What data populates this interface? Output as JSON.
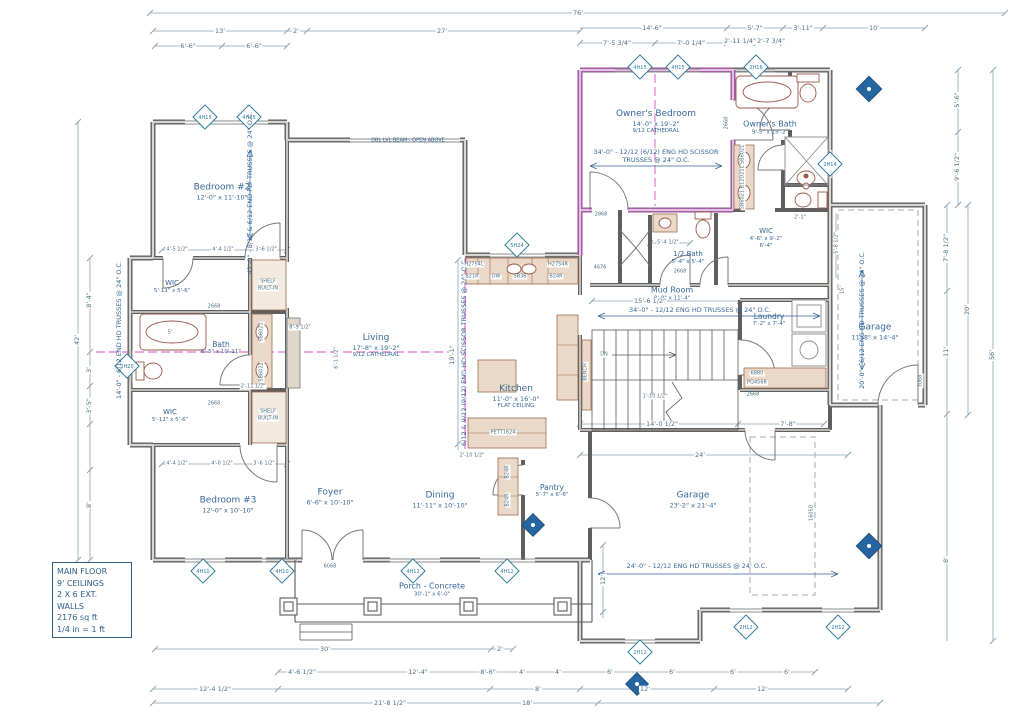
{
  "drawing": {
    "title_block": {
      "lines": [
        "MAIN FLOOR",
        "9' CEILINGS",
        "2 X 6 EXT.",
        "WALLS",
        "2176 sq ft",
        "1/4 in = 1 ft"
      ]
    },
    "rooms": {
      "bedroom2": {
        "name": "Bedroom #2",
        "size": "12'-0\" x 11'-10\""
      },
      "wic_top": {
        "name": "WIC",
        "size": "5'-11\" x 5'-6\""
      },
      "bath": {
        "name": "Bath",
        "size": "6'-5\" x 10'-11\""
      },
      "wic_bottom": {
        "name": "WIC",
        "size": "5'-11\" x 5'-6\""
      },
      "bedroom3": {
        "name": "Bedroom #3",
        "size": "12'-0\" x 10'-10\""
      },
      "foyer": {
        "name": "Foyer",
        "size": "6'-6\" x 10'-10\""
      },
      "living": {
        "name": "Living",
        "size": "17'-8\" x 19'-2\"",
        "note": "9/12 CATHEDRAL"
      },
      "dining": {
        "name": "Dining",
        "size": "11'-11\" x 10'-10\""
      },
      "kitchen": {
        "name": "Kitchen",
        "size": "11'-0\" x 16'-0\"",
        "note": "FLAT CEILING"
      },
      "pantry": {
        "name": "Pantry",
        "size": "5'-7\" x 6'-6\""
      },
      "owners_bedroom": {
        "name": "Owner's Bedroom",
        "size": "14'-0\" x 19'-2\"",
        "note": "9/12 CATHEDRAL"
      },
      "owners_bath": {
        "name": "Owner's Bath",
        "size": "9'-5\" x 19'-2\""
      },
      "owners_wic": {
        "name": "WIC",
        "size": "4'-6\" x 9'-2\"",
        "note": "6'-4\""
      },
      "half_bath": {
        "name": "1/2 Bath",
        "size": "5'-4\" x 5'-4\""
      },
      "mud_room": {
        "name": "Mud Room",
        "size": "8'-8\" x 11'-4\""
      },
      "laundry": {
        "name": "Laundry",
        "size": "7'-2\" x 7'-4\""
      },
      "garage_single": {
        "name": "Garage",
        "size": "11'-8\" x 14'-4\""
      },
      "garage_main": {
        "name": "Garage",
        "size": "23'-2\" x 21'-4\""
      },
      "porch": {
        "name": "Porch - Concrete",
        "size": "30'-1\" x 6'-0\""
      }
    },
    "truss_notes": {
      "left_wing": "42'-0\" - 8/12 & 6/12 END PLY TRUSSES @ 24\" O.C.",
      "owners_line1": "34'-0\" - 12/12 (6/12) ENG HD SCISSOR",
      "owners_line2": "TRUSSES @ 24\" O.C.",
      "living": "6/12 & 9/12 (9/12) ENG HD SCISSOR TRUSSES @ 24\" O.C.",
      "mud": "34'-0\" - 12/12 ENG HD TRUSSES @ 24\" O.C.",
      "garage_single": "20'-0\" - 6/12 ENG HD TRUSSES @ 24\" O.C.",
      "garage_main": "24'-0\" - 12/12 ENG HD TRUSSES @ 24' O.C.",
      "left_bump": "14'-0\" - 6/12 END HD TRUSSES @ 24\" O.C.",
      "beam": "DBL LVL BEAM - OPEN ABOVE"
    },
    "dims": {
      "top": [
        "76'",
        "13'",
        "2'",
        "27'",
        "14'-6\"",
        "5'-7\"",
        "3'-11\"",
        "10'"
      ],
      "top2": [
        "6'-6\"",
        "6'-6\"",
        "7'-5 3/4\"",
        "7'-0 1/4\"",
        "2'-11 1/4\"",
        "2'-7 3/4\""
      ],
      "right": [
        "5'-6\"",
        "9'-6 1/2\"",
        "7'-8 1/2\"",
        "11'",
        "20'",
        "8'",
        "56'",
        "5'-8 1/2\"",
        "15'"
      ],
      "left": [
        "42'",
        "8'-4\"",
        "3'",
        "3'-5\"",
        "8'"
      ],
      "bottom": [
        "30'",
        "2'",
        "4'-6 1/2\"",
        "12'-4\"",
        "8'-6\"",
        "4'",
        "4'",
        "6'",
        "6'",
        "6'",
        "6'",
        "12'-4 1/2\"",
        "8'",
        "12'",
        "12'",
        "21'-8 1/2\"",
        "18'"
      ],
      "interior": [
        "4'-5 1/2\"",
        "4'-4 1/2\"",
        "3'-6 1/2\"",
        "4'-4 1/2\"",
        "4'-0 1/2\"",
        "3'-6 1/2\"",
        "15'-6 1/2\"",
        "14'-0 1/2\"",
        "7'-8\"",
        "24'",
        "12'",
        "19'-1\"",
        "8'-9 1/2\"",
        "6'-1 1/2\"",
        "5'-4 1/2\"",
        "2'-1\"",
        "2'-10 1/2\"",
        "1'-10 1/2\"",
        "5'",
        "2'-11 1/2\""
      ]
    },
    "markers": [
      "4H15",
      "4H15",
      "4H15",
      "4H15",
      "2H16",
      "2H14",
      "5H24",
      "2H20",
      "4H10",
      "4H10",
      "4H12",
      "4H12",
      "2H12",
      "2H12",
      "2H12"
    ],
    "doors": [
      "6068",
      "2868",
      "2668",
      "2668",
      "2668",
      "2668",
      "4676",
      "3068",
      "16050",
      "2668"
    ],
    "fixtures_labels": {
      "kitchen": [
        "H2754L",
        "B21R",
        "DW",
        "SB36",
        "B24R",
        "H2754R"
      ],
      "island": "PETT1624",
      "pantry": [
        "B24R",
        "B24R"
      ],
      "laundry": [
        "6880",
        "PQ456R"
      ],
      "bath_vanity": [
        "SB6021",
        "SB6021"
      ],
      "owner_vanity": "SB6021 B12D21L SB6021",
      "shelf": [
        "SHELF",
        "BUILT-IN",
        "SHELF",
        "BUILT-IN"
      ],
      "bench": "BENCH",
      "stairs_dn": "DN"
    }
  }
}
